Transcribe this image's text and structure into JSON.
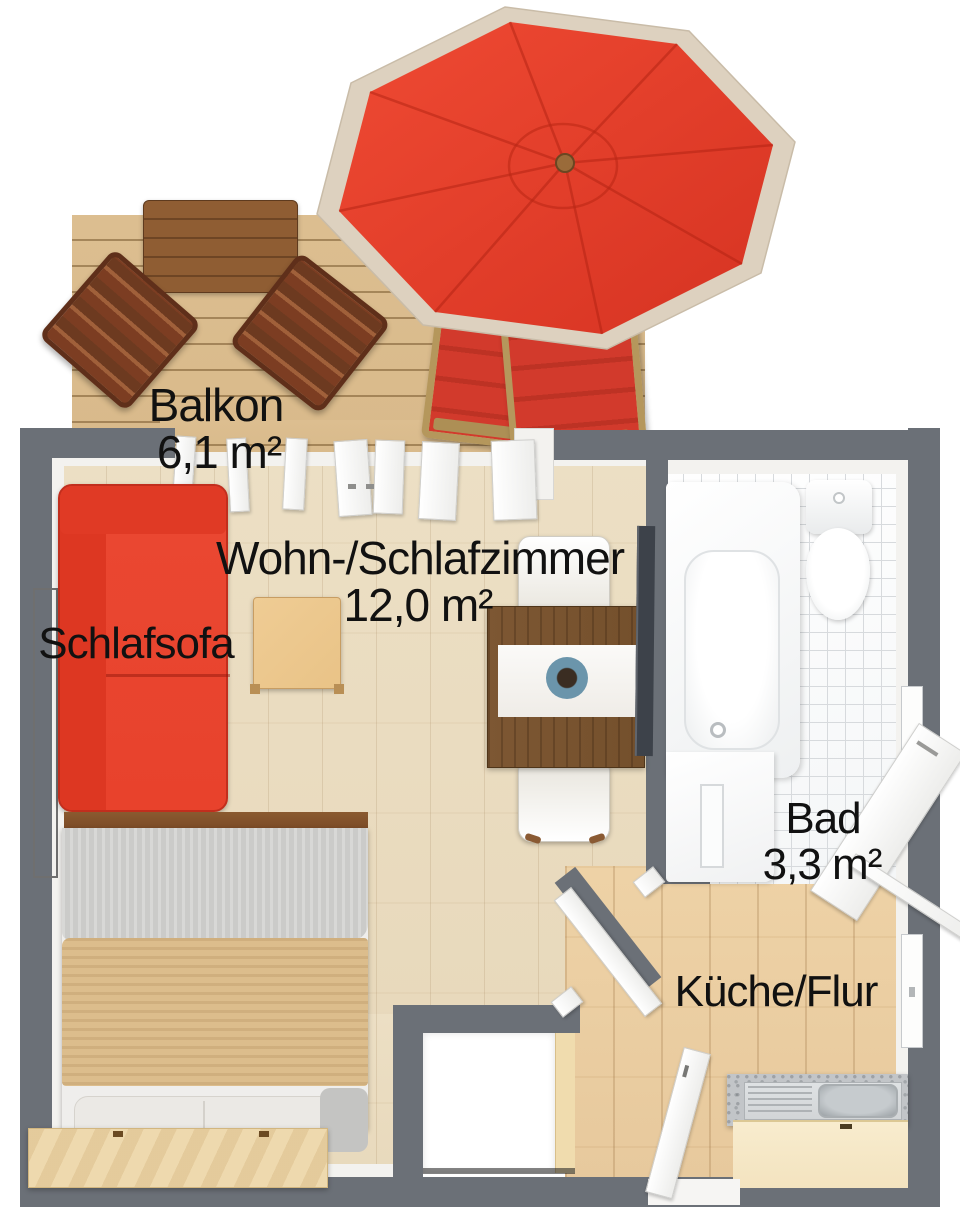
{
  "title": "Apartment floor plan",
  "rooms": [
    {
      "name": "Balkon",
      "area": "6,1 m²"
    },
    {
      "name": "Wohn-/Schlafzimmer",
      "area": "12,0 m²"
    },
    {
      "name": "Bad",
      "area": "3,3 m²"
    },
    {
      "name": "Küche/Flur"
    }
  ],
  "furniture": {
    "sofa_label": "Schlafsofa"
  },
  "colors": {
    "wall": "#6b7077",
    "wall_inner": "#f3f2ef",
    "deck_wood": "#d9ba8b",
    "living_floor": "#e8d9bc",
    "kitchen_floor": "#e7c99d",
    "tile": "#f4f6f7",
    "tile_line": "#d7dadd",
    "umbrella_red": "#e23b28",
    "umbrella_trim": "#ddd1bf",
    "table_wood": "#8f5d33",
    "chair_wood": "#7c3d22",
    "lounger_red": "#d23a2c",
    "lounger_frame": "#b5975c",
    "sofa_red": "#e8422c",
    "bed_rail": "#7b4a26",
    "bed_blanket_gray": "#cbcbc9",
    "bed_blanket_tan": "#dcbd8c",
    "headboard": "#eed9ae",
    "coffee_table": "#e9c387",
    "dining_table": "#74502c",
    "tv": "#3d424a",
    "counter_granite": "#c2c5c8",
    "counter_steel": "#d2d5d7",
    "counter_front": "#f3e3bf",
    "closet_door": "#f0dcae",
    "plant_blue": "#6b95ab",
    "label": "#111111"
  }
}
